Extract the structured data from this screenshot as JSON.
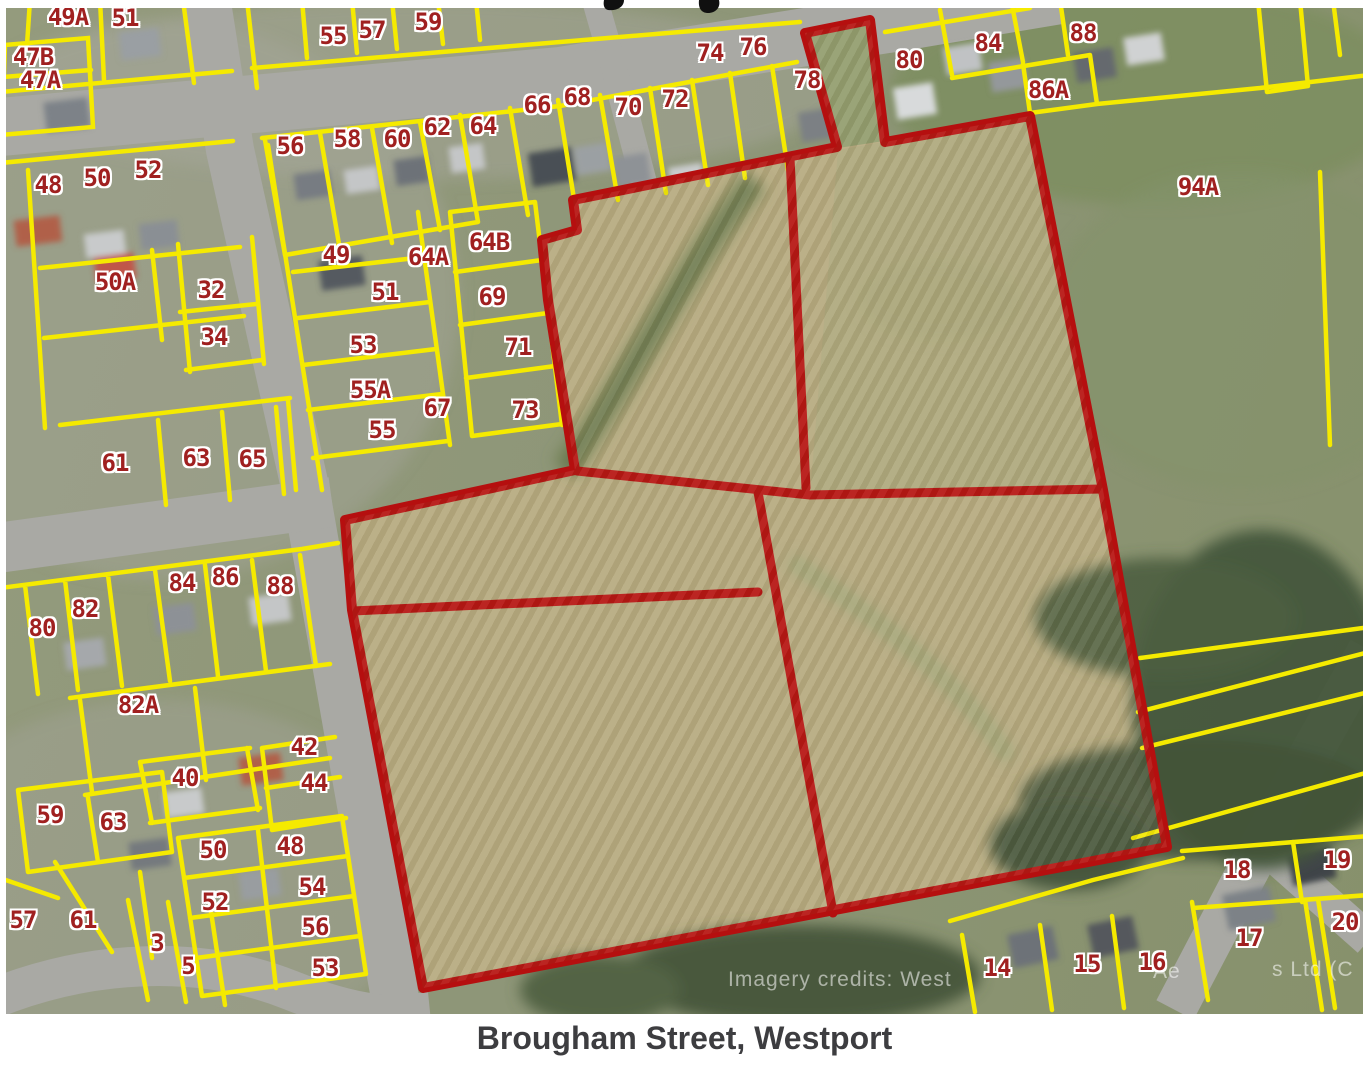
{
  "caption": {
    "text": "Brougham Street, Westport"
  },
  "watermark": {
    "fragments": [
      {
        "text": "Imagery credits: West",
        "x": 728,
        "y": 980
      },
      {
        "text": "Ae",
        "x": 1153,
        "y": 972
      },
      {
        "text": "s Ltd (C",
        "x": 1272,
        "y": 970
      }
    ]
  },
  "cropped_title_fragments": [
    ",",
    "g"
  ],
  "colors": {
    "site_boundary_red": "#b50f0f",
    "parcel_line_yellow": "#f5ea00",
    "label_red": "#a02020",
    "label_outline": "#ffffff",
    "caption_color": "#3d3d40",
    "paddock_tan": "#b6aa80",
    "road_gray": "#a9a9a4"
  },
  "map": {
    "parcel_labels": [
      {
        "text": "49A",
        "x": 68,
        "y": 17
      },
      {
        "text": "51",
        "x": 125,
        "y": 18
      },
      {
        "text": "55",
        "x": 333,
        "y": 36
      },
      {
        "text": "57",
        "x": 372,
        "y": 30
      },
      {
        "text": "59",
        "x": 428,
        "y": 22
      },
      {
        "text": "47B",
        "x": 33,
        "y": 57
      },
      {
        "text": "47A",
        "x": 40,
        "y": 80
      },
      {
        "text": "48",
        "x": 48,
        "y": 185
      },
      {
        "text": "50",
        "x": 97,
        "y": 178
      },
      {
        "text": "52",
        "x": 148,
        "y": 170
      },
      {
        "text": "56",
        "x": 290,
        "y": 146
      },
      {
        "text": "58",
        "x": 347,
        "y": 139
      },
      {
        "text": "60",
        "x": 397,
        "y": 139
      },
      {
        "text": "62",
        "x": 437,
        "y": 127
      },
      {
        "text": "64",
        "x": 483,
        "y": 126
      },
      {
        "text": "66",
        "x": 537,
        "y": 105
      },
      {
        "text": "68",
        "x": 577,
        "y": 97
      },
      {
        "text": "70",
        "x": 628,
        "y": 107
      },
      {
        "text": "72",
        "x": 675,
        "y": 99
      },
      {
        "text": "74",
        "x": 710,
        "y": 53
      },
      {
        "text": "76",
        "x": 753,
        "y": 47
      },
      {
        "text": "78",
        "x": 807,
        "y": 80
      },
      {
        "text": "80",
        "x": 909,
        "y": 60
      },
      {
        "text": "84",
        "x": 988,
        "y": 43
      },
      {
        "text": "88",
        "x": 1083,
        "y": 33
      },
      {
        "text": "86A",
        "x": 1048,
        "y": 90
      },
      {
        "text": "94A",
        "x": 1198,
        "y": 187
      },
      {
        "text": "50A",
        "x": 115,
        "y": 282
      },
      {
        "text": "32",
        "x": 211,
        "y": 290
      },
      {
        "text": "34",
        "x": 214,
        "y": 337
      },
      {
        "text": "49",
        "x": 336,
        "y": 255
      },
      {
        "text": "64A",
        "x": 428,
        "y": 257
      },
      {
        "text": "51",
        "x": 385,
        "y": 292
      },
      {
        "text": "53",
        "x": 363,
        "y": 345
      },
      {
        "text": "55A",
        "x": 370,
        "y": 390
      },
      {
        "text": "55",
        "x": 382,
        "y": 430
      },
      {
        "text": "67",
        "x": 437,
        "y": 408
      },
      {
        "text": "61",
        "x": 115,
        "y": 463
      },
      {
        "text": "63",
        "x": 196,
        "y": 458
      },
      {
        "text": "65",
        "x": 252,
        "y": 459
      },
      {
        "text": "64B",
        "x": 489,
        "y": 242
      },
      {
        "text": "69",
        "x": 492,
        "y": 297
      },
      {
        "text": "71",
        "x": 518,
        "y": 347
      },
      {
        "text": "73",
        "x": 525,
        "y": 410
      },
      {
        "text": "84",
        "x": 182,
        "y": 583
      },
      {
        "text": "86",
        "x": 225,
        "y": 577
      },
      {
        "text": "88",
        "x": 280,
        "y": 586
      },
      {
        "text": "82",
        "x": 85,
        "y": 609
      },
      {
        "text": "80",
        "x": 42,
        "y": 628
      },
      {
        "text": "82A",
        "x": 138,
        "y": 705
      },
      {
        "text": "42",
        "x": 304,
        "y": 747
      },
      {
        "text": "40",
        "x": 185,
        "y": 778
      },
      {
        "text": "44",
        "x": 314,
        "y": 783
      },
      {
        "text": "59",
        "x": 50,
        "y": 815
      },
      {
        "text": "63",
        "x": 113,
        "y": 822
      },
      {
        "text": "50",
        "x": 213,
        "y": 850
      },
      {
        "text": "48",
        "x": 290,
        "y": 846
      },
      {
        "text": "54",
        "x": 312,
        "y": 887
      },
      {
        "text": "52",
        "x": 215,
        "y": 902
      },
      {
        "text": "57",
        "x": 23,
        "y": 920
      },
      {
        "text": "61",
        "x": 83,
        "y": 920
      },
      {
        "text": "3",
        "x": 157,
        "y": 943
      },
      {
        "text": "5",
        "x": 188,
        "y": 966
      },
      {
        "text": "56",
        "x": 315,
        "y": 927
      },
      {
        "text": "53",
        "x": 325,
        "y": 968
      },
      {
        "text": "14",
        "x": 997,
        "y": 968
      },
      {
        "text": "15",
        "x": 1087,
        "y": 964
      },
      {
        "text": "16",
        "x": 1152,
        "y": 962
      },
      {
        "text": "17",
        "x": 1249,
        "y": 938
      },
      {
        "text": "18",
        "x": 1237,
        "y": 870
      },
      {
        "text": "19",
        "x": 1337,
        "y": 860
      },
      {
        "text": "20",
        "x": 1345,
        "y": 922
      }
    ]
  }
}
